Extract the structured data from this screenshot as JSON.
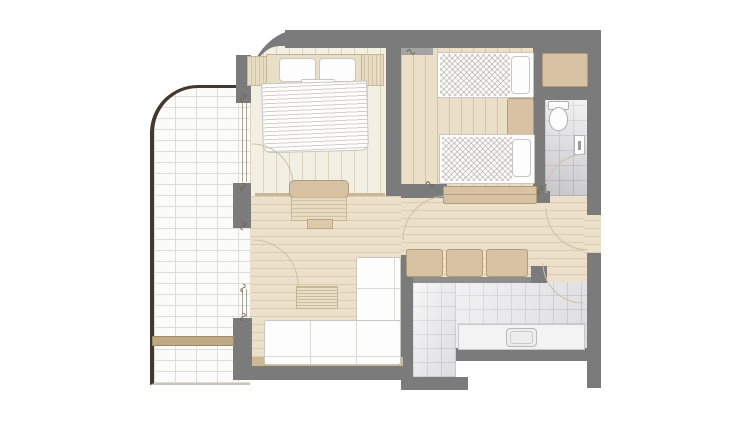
{
  "palette": {
    "bg": "#ffffff",
    "wall": "#7b7b7b",
    "wall_light": "#a3a3a3",
    "railing": "#42382e",
    "balcony_brick": "#fbfbf9",
    "brick_line": "#dddcd6",
    "floor_master": "#f4efe3",
    "floor_twin": "#ebdfc8",
    "floor_living": "#ece0cb",
    "floor_kitchen": "#ededee",
    "floor_bath": "#e9e9ea",
    "furniture_tan": "#d8c2a4",
    "furniture_tan_border": "#b49a77",
    "wood_light": "#e7dbc2",
    "furn_white": "#fdfdfd",
    "furn_outline": "#c6c6c2",
    "bench": "#bfa886",
    "arc_line": "#cbbfa8",
    "glazing_line": "#a8a399",
    "tick_mark": "#6f604a"
  },
  "plan": {
    "type": "apartment-floor-plan",
    "rooms": [
      {
        "id": "balcony",
        "floor": "white-brick",
        "furniture": [
          "bench"
        ]
      },
      {
        "id": "master-bedroom",
        "floor": "light-wood-planks",
        "furniture": [
          "double-bed",
          "headboard",
          "pillows",
          "nightstand-left",
          "nightstand-right",
          "desk-console",
          "drawer-stool"
        ]
      },
      {
        "id": "twin-bedroom",
        "floor": "wood-planks",
        "furniture": [
          "twin-bed-top",
          "twin-bed-bottom",
          "nightstand-between-beds",
          "sideboard"
        ]
      },
      {
        "id": "bathroom",
        "floor": "gray-tile",
        "furniture": [
          "toilet",
          "wall-dispenser"
        ]
      },
      {
        "id": "wardrobe-niche",
        "furniture": [
          "wardrobe"
        ]
      },
      {
        "id": "corridor-living",
        "floor": "wood-planks",
        "furniture": [
          "l-sofa-bottom",
          "l-sofa-side",
          "coffee-table",
          "cabinet-row"
        ]
      },
      {
        "id": "kitchen",
        "floor": "white-tile",
        "furniture": [
          "counter",
          "sink"
        ]
      },
      {
        "id": "entry",
        "features": [
          "entry-door-arc"
        ]
      }
    ],
    "doors": [
      "balcony-door-living",
      "balcony-door-bedroom",
      "bathroom-door",
      "entry-door",
      "kitchen-door",
      "twin-bedroom-door"
    ],
    "windows": [
      "balcony-window-upper",
      "balcony-window-lower"
    ]
  }
}
